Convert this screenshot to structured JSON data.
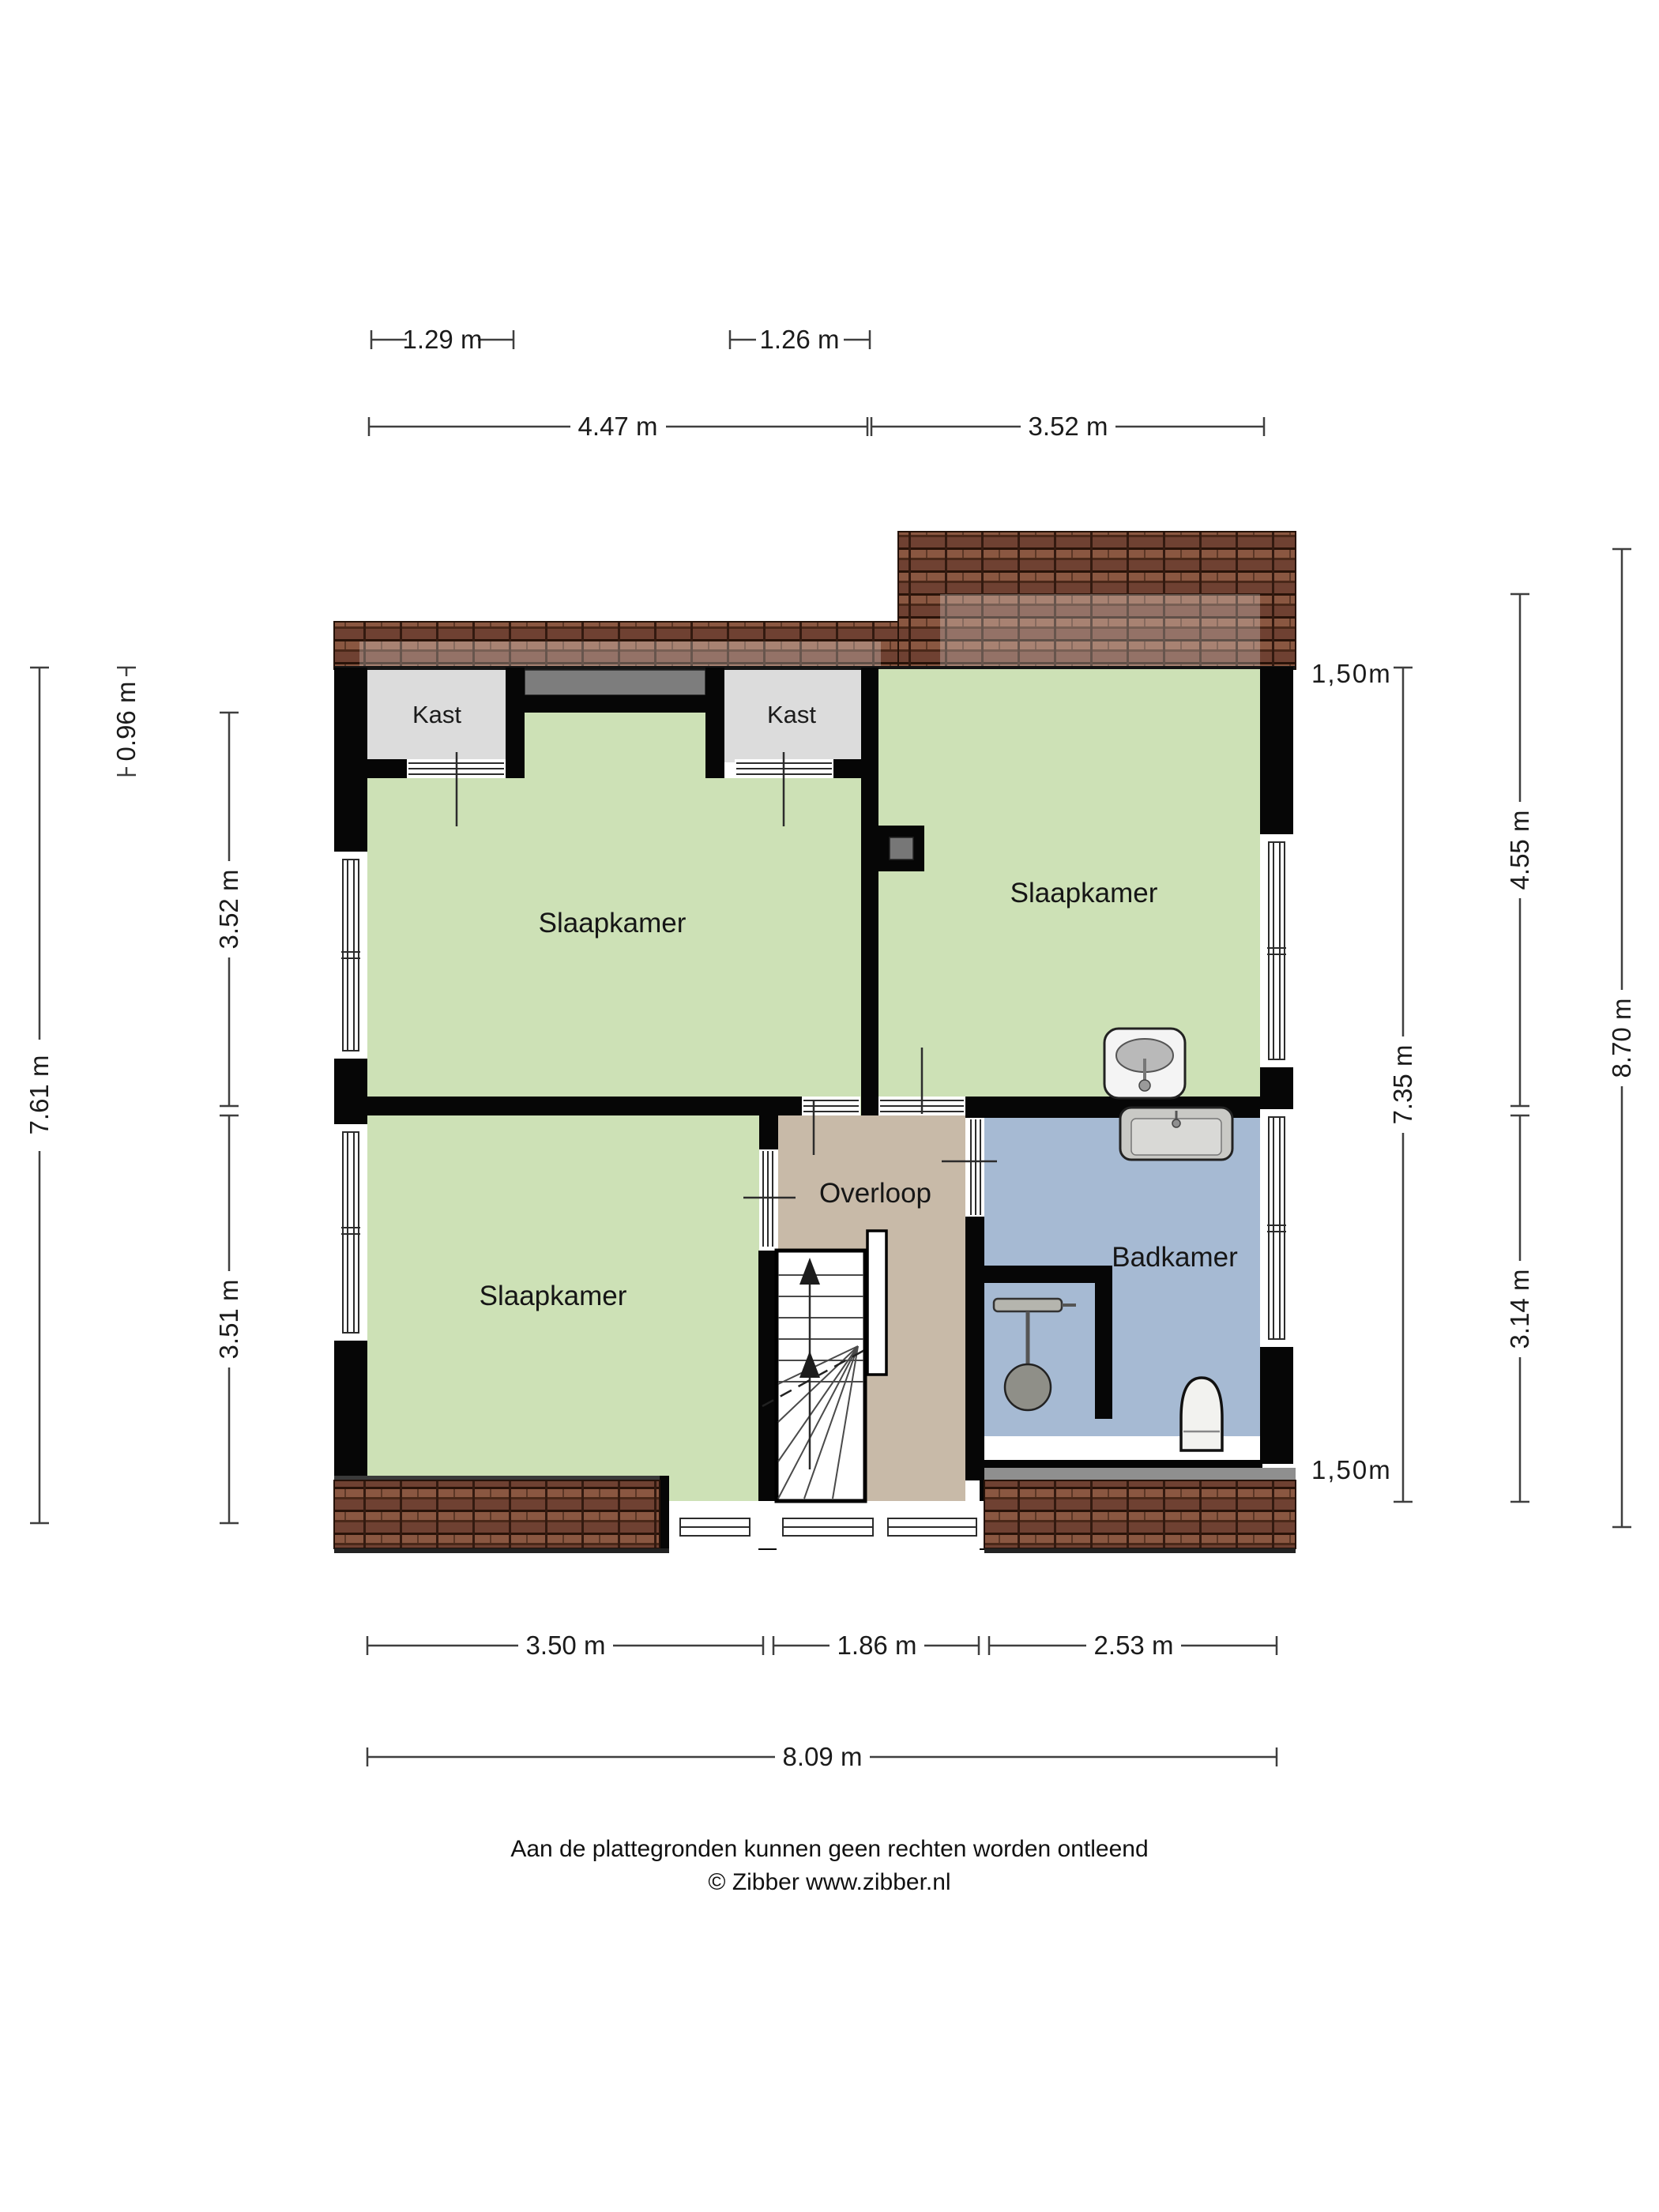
{
  "floorplan": {
    "rooms": {
      "bedroom_tl": "Slaapkamer",
      "bedroom_tr": "Slaapkamer",
      "bedroom_bl": "Slaapkamer",
      "closet_left": "Kast",
      "closet_right": "Kast",
      "landing": "Overloop",
      "bathroom": "Badkamer"
    },
    "dims": {
      "t1": "1.29 m",
      "t2": "1.26 m",
      "t3": "4.47 m",
      "t4": "3.52 m",
      "l1": "0.96 m",
      "l2": "7.61 m",
      "l3": "3.52 m",
      "l4": "3.51 m",
      "r1": "7.35 m",
      "r2": "4.55 m",
      "r3": "3.14 m",
      "r4": "8.70 m",
      "b1": "3.50 m",
      "b2": "1.86 m",
      "b3": "2.53 m",
      "b4": "8.09 m"
    },
    "height_markers": {
      "top": "1,50m",
      "bottom": "1,50m"
    },
    "footer": {
      "line1": "Aan de plattegronden kunnen geen rechten worden ontleend",
      "line2": "© Zibber www.zibber.nl"
    },
    "colors": {
      "room_green": "#cde1b6",
      "bathroom_blue": "#a6bad3",
      "landing_beige": "#c8baa8",
      "closet_gray": "#dcdcdc",
      "recess_gray": "#7d7d7d",
      "roof_brown": "#6f4132",
      "wall_black": "#060606"
    }
  }
}
